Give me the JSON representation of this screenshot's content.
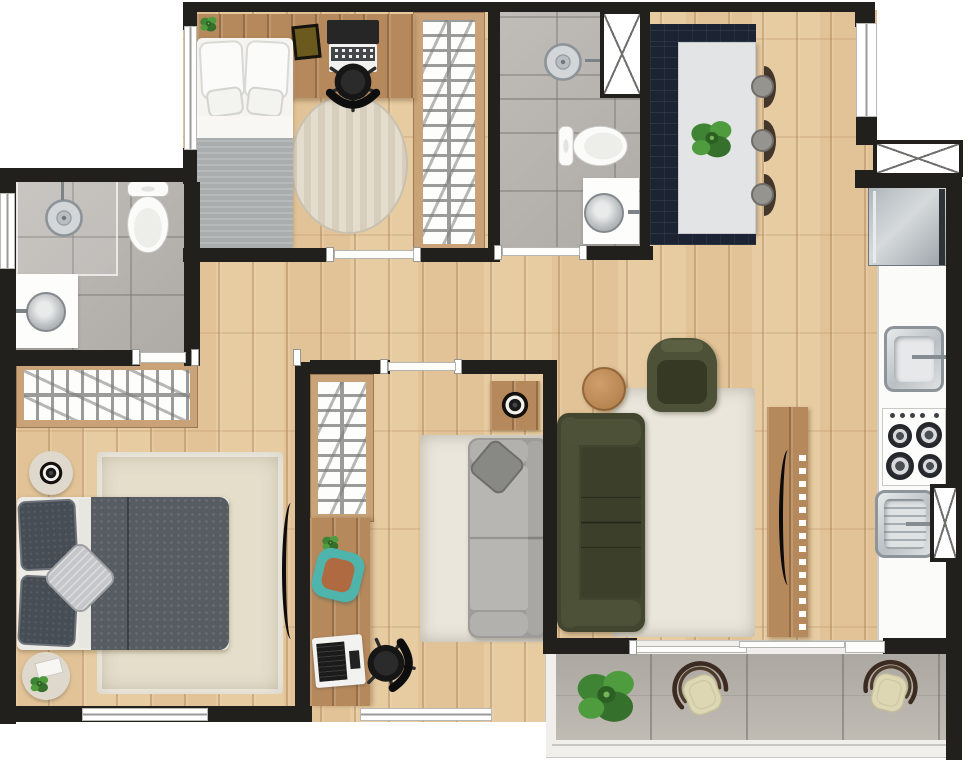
{
  "meta": {
    "title": "apartment-floor-plan",
    "view": "2d-top-down-render",
    "canvas": {
      "width": 968,
      "height": 760
    },
    "visible_text": "none"
  },
  "palette": {
    "wall": "#21201d",
    "floor": "#e7cba1",
    "desk": "#b6895c",
    "closetFrame": "#c9a277",
    "tile": "#b9b5b0",
    "balconyTile": "#b3afa8",
    "navy": "#1c2434",
    "tableTop": "#e3e4e6",
    "olive": "#42462f",
    "oliveLight": "#4d5138",
    "graySofa": "#b2b1ae",
    "creamRug": "#eae6dc",
    "shagRug": "#e5decb",
    "duvet": "#565c62",
    "pillow": "#464d55",
    "teal": "#4fb5ac",
    "cushionBrown": "#b06a42",
    "stoolDark": "#43372c",
    "stoolCushion": "#96948f",
    "chairCream": "#ddd7b4",
    "chairFrame": "#3b2b20",
    "plantGreen": "#4f9c3e",
    "plantDark": "#35702c",
    "steel": "#b9bfc3",
    "fridgeLight": "#cdd2d5",
    "fridgeDark": "#8a9299",
    "hatchLine": "#9b9b99"
  },
  "rooms": [
    {
      "id": "bedroom-top",
      "kind": "bedroom",
      "features": [
        "single-bed",
        "desk-with-laptop",
        "office-chair",
        "books",
        "small-plant",
        "oval-rug",
        "wardrobe-hatch",
        "window-left",
        "door-to-hall"
      ]
    },
    {
      "id": "bathroom-top",
      "kind": "bathroom",
      "features": [
        "shower-drain",
        "shower-head",
        "toilet",
        "round-basin",
        "duct-shaft",
        "door-to-hall"
      ]
    },
    {
      "id": "kitchen-dining",
      "kind": "kitchen-dining",
      "features": [
        "navy-island",
        "white-dining-table",
        "three-stools",
        "plant-centerpiece",
        "fridge",
        "entry-opening",
        "duct-shaft"
      ]
    },
    {
      "id": "bathroom-left",
      "kind": "bathroom",
      "features": [
        "shower-drain",
        "shower-head",
        "toilet",
        "vanity-round-basin",
        "window-left",
        "door-to-master"
      ]
    },
    {
      "id": "master-bedroom",
      "kind": "bedroom",
      "features": [
        "double-bed",
        "two-round-side-tables",
        "speaker",
        "accent-pillow",
        "shag-rug",
        "wardrobe-hatch",
        "wall-tv",
        "window-bottom"
      ]
    },
    {
      "id": "office-room",
      "kind": "office",
      "features": [
        "wardrobe-hatch",
        "desk-strip",
        "teal-chair",
        "laptop",
        "office-chair",
        "gray-sofa",
        "cream-rug",
        "shelf-with-speaker",
        "window-bottom"
      ]
    },
    {
      "id": "living-room",
      "kind": "living",
      "features": [
        "olive-sofa",
        "olive-armchair",
        "round-wood-table",
        "cream-rug",
        "tv-console",
        "tv"
      ]
    },
    {
      "id": "kitchen-strip",
      "kind": "kitchen-counter",
      "features": [
        "sink",
        "gas-cooktop-4-burners",
        "second-sink-with-drainboard",
        "duct-shaft",
        "service-door"
      ]
    },
    {
      "id": "balcony",
      "kind": "balcony",
      "features": [
        "stone-tile",
        "large-plant",
        "two-cream-chairs",
        "sliding-glass-door",
        "railing"
      ]
    }
  ],
  "openings": {
    "windows": [
      "bedroom-top-left",
      "bathroom-left-wall",
      "master-bottom",
      "office-bottom",
      "dining-right-entry"
    ],
    "doors": [
      "bedroom-top",
      "bathroom-top",
      "bathroom-left",
      "master-gap",
      "office-room",
      "balcony-sliding",
      "balcony-service"
    ],
    "shafts": [
      "bathroom-top-shaft",
      "entry-side-shaft",
      "kitchen-bottom-shaft"
    ]
  }
}
